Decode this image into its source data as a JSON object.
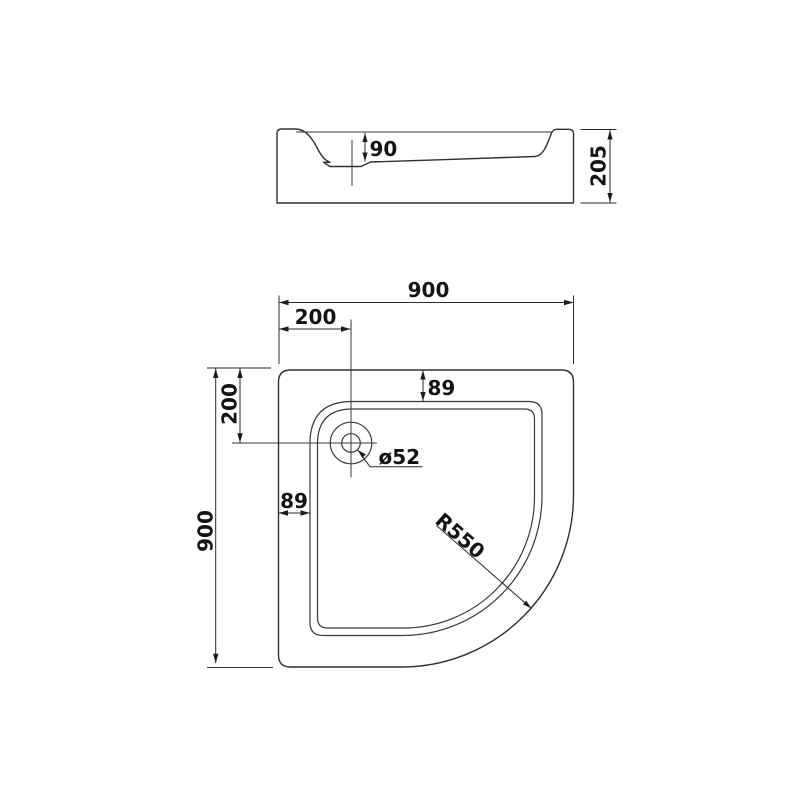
{
  "drawing": {
    "background": "#ffffff",
    "line_color": "#333333",
    "text_color": "#141414",
    "side_view": {
      "basin_depth": "90",
      "overall_height": "205"
    },
    "plan_view": {
      "overall_width": "900",
      "overall_depth": "900",
      "drain_offset_from_left": "200",
      "drain_offset_from_top": "200",
      "rim_width_top": "89",
      "rim_width_left": "89",
      "drain_diameter": "ø52",
      "front_corner_radius": "R550"
    }
  }
}
